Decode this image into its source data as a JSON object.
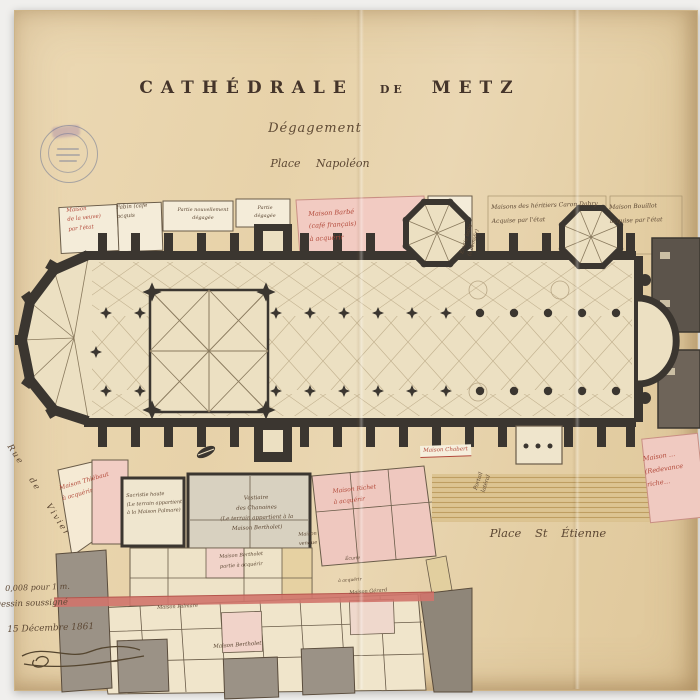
{
  "title": {
    "word1": "CATHÉDRALE",
    "word2": "DE",
    "word3": "METZ",
    "subtitle": "Dégagement",
    "place": "Place Napoléon"
  },
  "labels": {
    "maison_veuve": "Maison\nde la veuve)\npar l'état",
    "fabin": "Fabin (café\nacquis",
    "partie_degagee1": "Partie nouvellement\ndégagée",
    "partie_degagee2": "Partie\ndégagée",
    "maison_barbe": "Maison Barbé\n(café français)\nà acquérir",
    "ecurie_demolir": "Écurie bâtie\n(à démolir)",
    "caron_dabry": "Maisons des héritiers Caron Dabry\nAcquise par l'état",
    "maison_bouillot": "Maison Bouillot\nacquise par l'état",
    "rue_vivier": "Rue de Vivier",
    "maison_thiebaut": "Maison Thiébaut\nà acquérir",
    "sacristie": "Sacristie haute\n(Le terrain appartient\nà la Maison Palmare)",
    "vestiaire": "Vestiaire\ndes Chanoines\n(Le terrain appartient à la\nMaison Bertholet)",
    "maison_richet": "Maison Richet\nà acquérir",
    "maison_chabert": "Maison Chabert",
    "portail_lateral": "Portail\nlatéral",
    "maison_bertholet_part": "Maison Bertholet\npartie à acquérir",
    "maison_vendue": "Maison\nvendue",
    "ecurie": "Écurie",
    "a_acquerir": "à acquérir",
    "maison_palmare": "Maison Palmare",
    "maison_bertholet2": "Maison Bertholet",
    "maison_gerard": "Maison Gérard",
    "maison_redevance": "Maison …\n(Redevance\nriche…",
    "place_st_etienne": "Place St Étienne"
  },
  "footer": {
    "scale": "0,008 pour 1 m.",
    "drawn_by": "Dessin soussigné",
    "date": "15 Décembre 1861"
  },
  "colors": {
    "paper": "#e8d4ad",
    "ink_dark": "#3b3630",
    "ink_brown": "#5c4733",
    "ink_red": "#b2493a",
    "wash_pink": "#f1cac1",
    "wash_gray": "#9a9186",
    "wash_tan": "#dcc392"
  }
}
